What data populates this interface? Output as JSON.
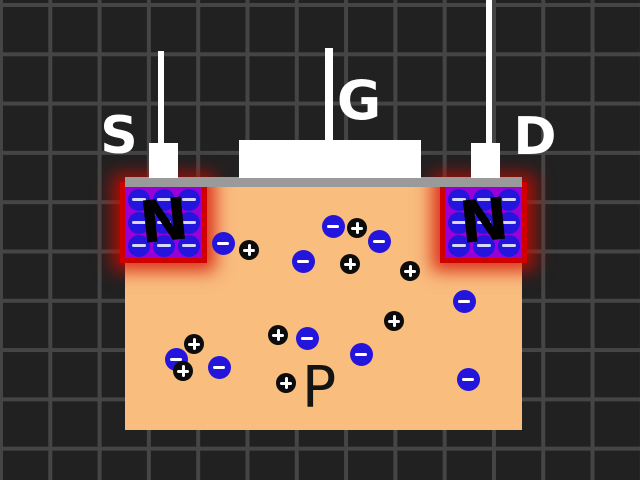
{
  "title": "N-channel MOSFET cross-section diagram",
  "colors": {
    "bg": "#212121",
    "grid": "#454545",
    "substrate": "#f9bd7e",
    "oxide": "#9a9a9a",
    "nregion": "#9800d8",
    "glow": "#cf0000",
    "contact": "#ffffff",
    "carrier_electron": "#2415dd",
    "carrier_hole": "#0c0c0c"
  },
  "terminals": {
    "source": {
      "label": "S"
    },
    "gate": {
      "label": "G"
    },
    "drain": {
      "label": "D"
    }
  },
  "regions": {
    "n_left": {
      "label": "N"
    },
    "n_right": {
      "label": "N"
    },
    "substrate": {
      "label": "P"
    }
  },
  "n_region_electron_grid": {
    "rows": 3,
    "cols": 3,
    "symbol": "−"
  },
  "particles": {
    "electrons": {
      "symbol": "−",
      "items": [
        {
          "x": 223,
          "y": 243
        },
        {
          "x": 333,
          "y": 226
        },
        {
          "x": 379,
          "y": 241
        },
        {
          "x": 303,
          "y": 261
        },
        {
          "x": 464,
          "y": 301
        },
        {
          "x": 307,
          "y": 338
        },
        {
          "x": 361,
          "y": 354
        },
        {
          "x": 176,
          "y": 359
        },
        {
          "x": 219,
          "y": 367
        },
        {
          "x": 468,
          "y": 379
        }
      ]
    },
    "holes": {
      "symbol": "+",
      "items": [
        {
          "x": 357,
          "y": 228
        },
        {
          "x": 249,
          "y": 250
        },
        {
          "x": 350,
          "y": 264
        },
        {
          "x": 410,
          "y": 271
        },
        {
          "x": 394,
          "y": 321
        },
        {
          "x": 278,
          "y": 335
        },
        {
          "x": 194,
          "y": 344
        },
        {
          "x": 183,
          "y": 371
        },
        {
          "x": 286,
          "y": 383
        }
      ]
    }
  }
}
